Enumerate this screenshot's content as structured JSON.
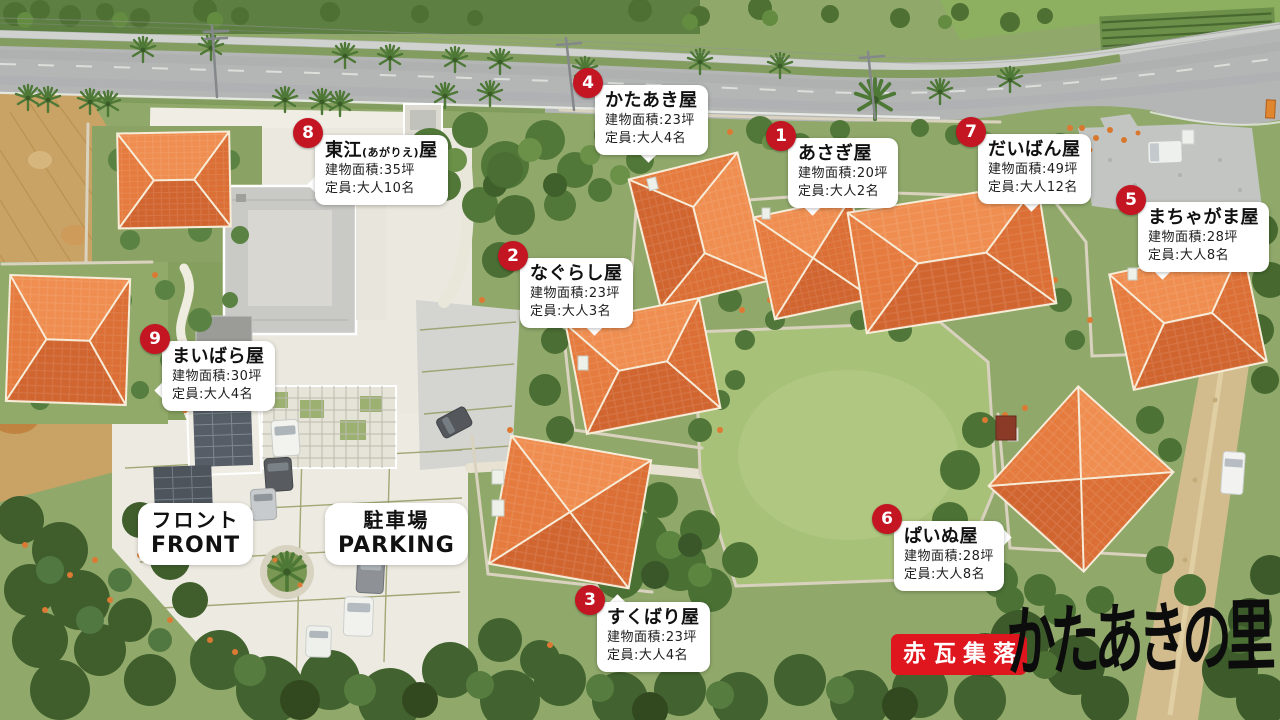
{
  "facilities": [
    {
      "number": "1",
      "name": "あさぎ屋",
      "area": "建物面積:20坪",
      "capacity": "定員:大人2名"
    },
    {
      "number": "2",
      "name": "なぐらし屋",
      "area": "建物面積:23坪",
      "capacity": "定員:大人3名"
    },
    {
      "number": "3",
      "name": "すくばり屋",
      "area": "建物面積:23坪",
      "capacity": "定員:大人4名"
    },
    {
      "number": "4",
      "name": "かたあき屋",
      "area": "建物面積:23坪",
      "capacity": "定員:大人4名"
    },
    {
      "number": "5",
      "name": "まちゃがま屋",
      "area": "建物面積:28坪",
      "capacity": "定員:大人8名"
    },
    {
      "number": "6",
      "name": "ぱいぬ屋",
      "area": "建物面積:28坪",
      "capacity": "定員:大人8名"
    },
    {
      "number": "7",
      "name": "だいばん屋",
      "area": "建物面積:49坪",
      "capacity": "定員:大人12名"
    },
    {
      "number": "8",
      "name_main": "東江",
      "name_reading": "(あがりえ)",
      "name_tail": "屋",
      "area": "建物面積:35坪",
      "capacity": "定員:大人10名"
    },
    {
      "number": "9",
      "name": "まいばら屋",
      "area": "建物面積:30坪",
      "capacity": "定員:大人4名"
    }
  ],
  "area_labels": {
    "front": {
      "jp": "フロント",
      "en": "FRONT"
    },
    "parking": {
      "jp": "駐車場",
      "en": "PARKING"
    }
  },
  "logo": {
    "badge_text": "赤瓦集落",
    "site_name": "かたあきの里"
  },
  "colors": {
    "marker_red": "#c31522",
    "logo_red": "#e0161f",
    "bubble_white": "#ffffff",
    "roof_orange": "#e2733a"
  }
}
